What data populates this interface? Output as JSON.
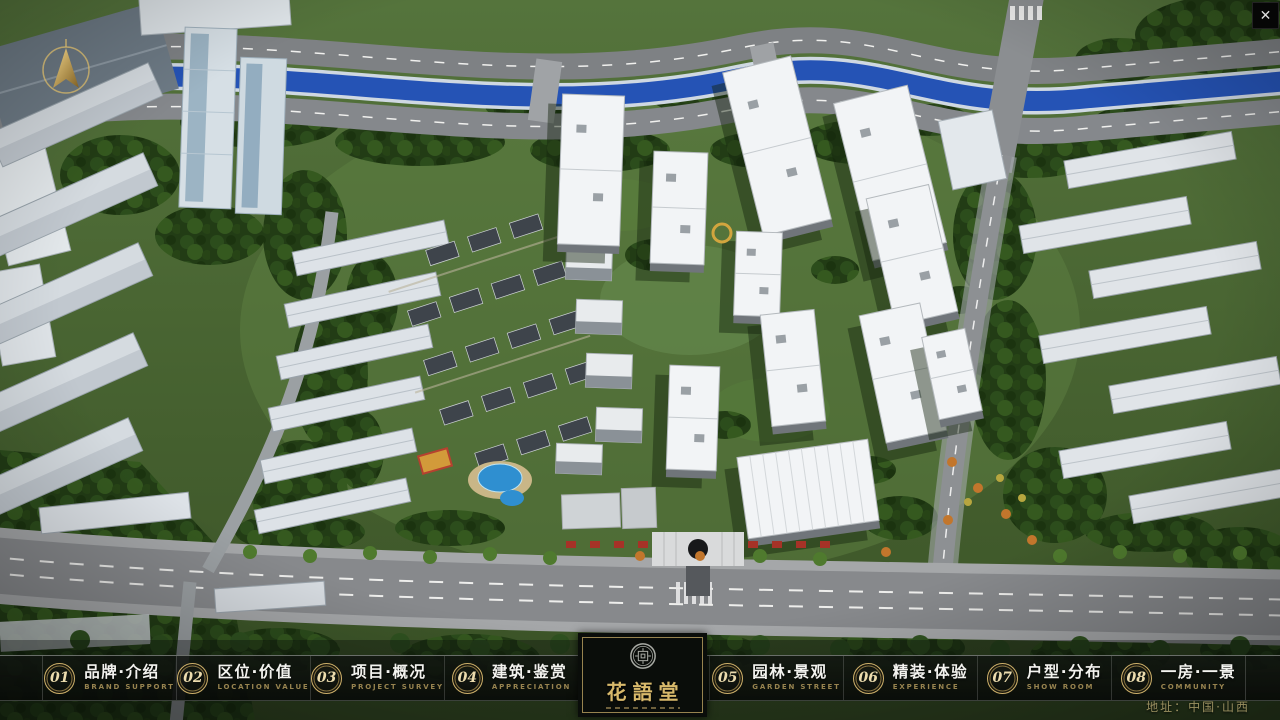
{
  "window": {
    "close_glyph": "✕"
  },
  "nav": {
    "items": [
      {
        "num": "01",
        "label": "品牌·介绍",
        "sub": "BRAND SUPPORT"
      },
      {
        "num": "02",
        "label": "区位·价值",
        "sub": "LOCATION VALUE"
      },
      {
        "num": "03",
        "label": "项目·概况",
        "sub": "PROJECT SURVEY"
      },
      {
        "num": "04",
        "label": "建筑·鉴赏",
        "sub": "APPRECIATION"
      },
      {
        "num": "05",
        "label": "园林·景观",
        "sub": "GARDEN STREET"
      },
      {
        "num": "06",
        "label": "精装·体验",
        "sub": "EXPERIENCE"
      },
      {
        "num": "07",
        "label": "户型·分布",
        "sub": "SHOW ROOM"
      },
      {
        "num": "08",
        "label": "一房·一景",
        "sub": "COMMUNITY"
      }
    ]
  },
  "logo": {
    "title": "花語堂"
  },
  "footer": {
    "address": "地址：中国·山西"
  },
  "colors": {
    "gold_accent": "#c9a85e",
    "bar_background": "#0d110e",
    "river_blue": "#2553b5",
    "grass_green": "#4a672f",
    "road_gray": "#87898c",
    "roof_white": "#f2f4f6"
  }
}
